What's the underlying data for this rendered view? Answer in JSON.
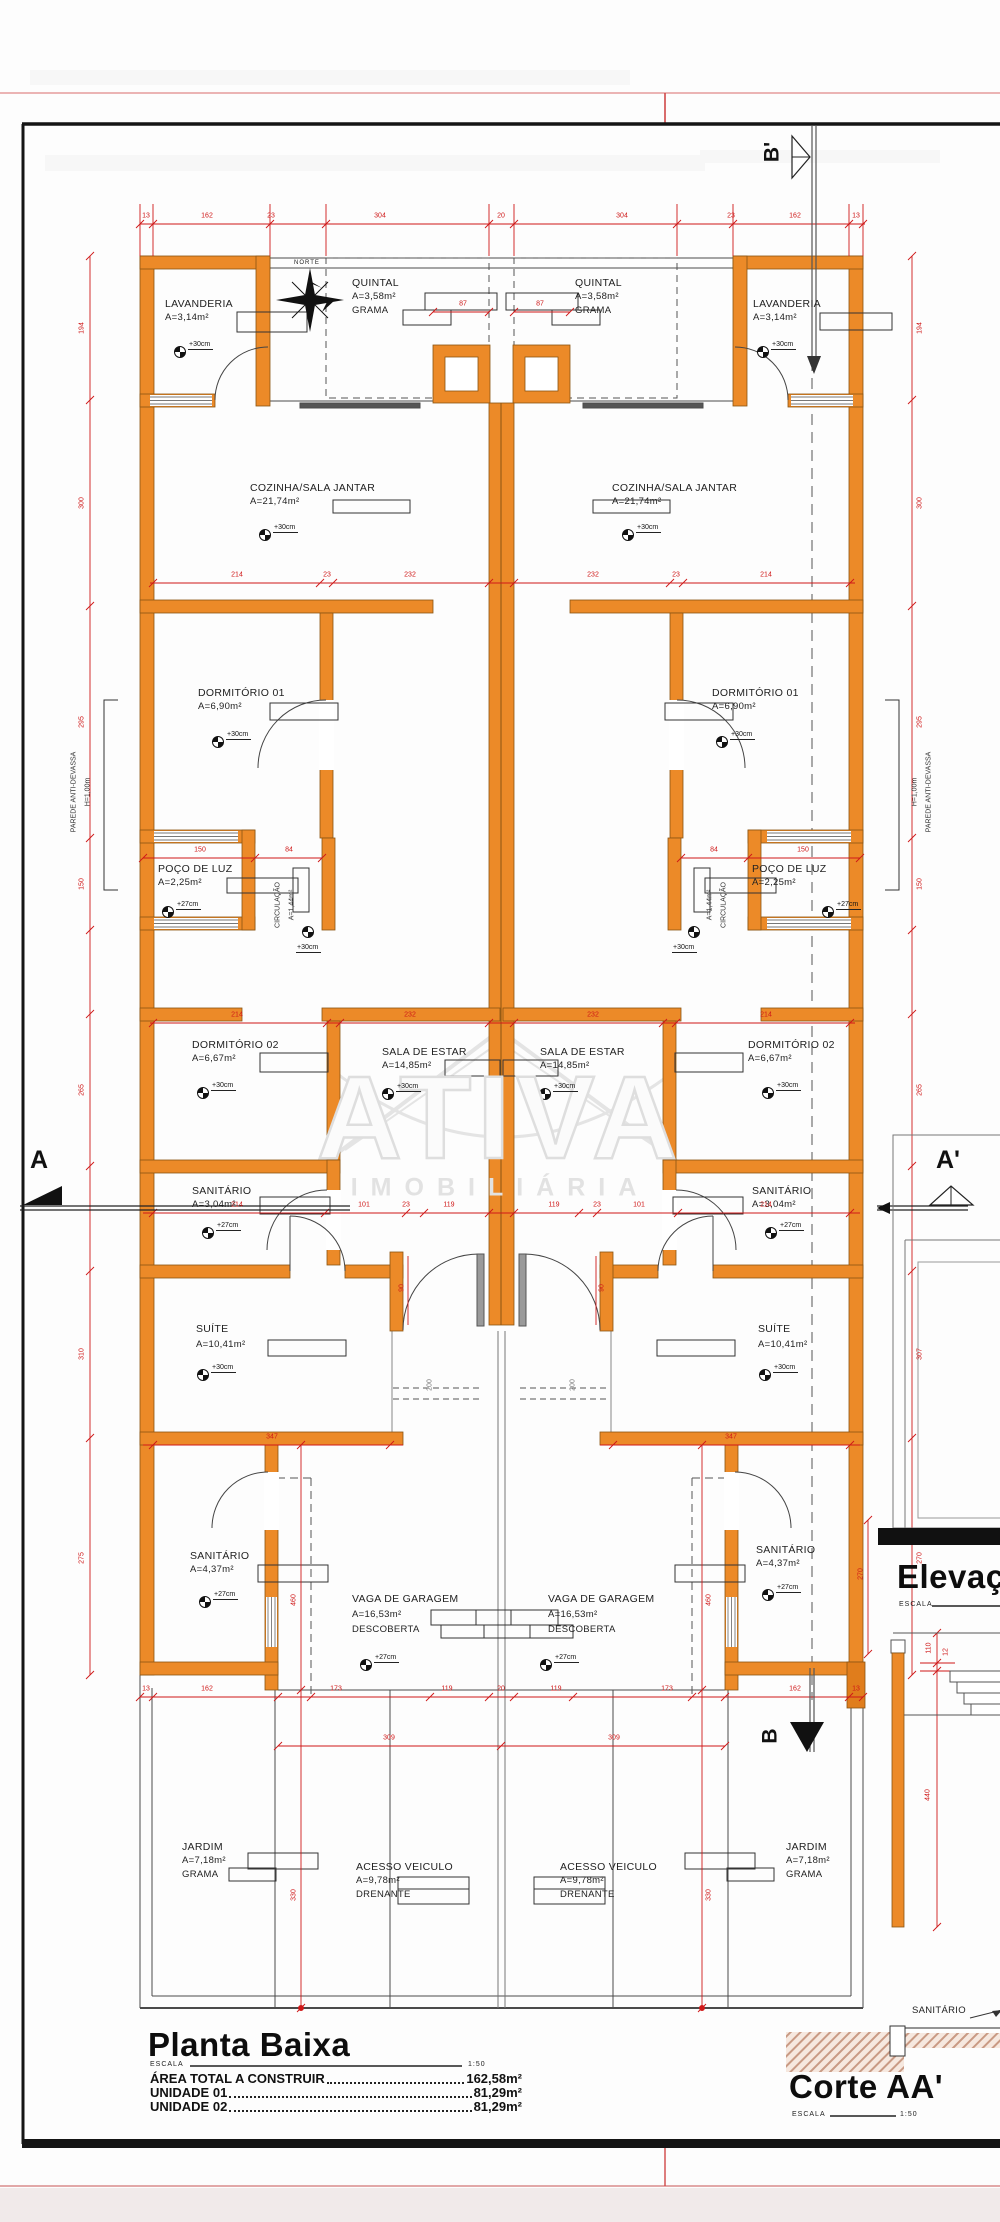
{
  "sheet": {
    "wall_color": "#EC8A28",
    "dim_color": "#CF1818"
  },
  "watermark": {
    "line1": "ATIVA",
    "line2": "IMOBILIÁRIA"
  },
  "compass_label": "NORTE",
  "markers": {
    "a": "A",
    "a_prime": "A'",
    "b": "B",
    "b_prime": "B'"
  },
  "notes": {
    "parede": "PAREDE ANTI-DEVASSA",
    "parede_h": "H=1,00m",
    "corte_sanitario": "SANITÁRIO"
  },
  "rooms": {
    "lavanderia": {
      "name": "LAVANDERIA",
      "area": "A=3,14m²",
      "level": "+30cm"
    },
    "quintal": {
      "name": "QUINTAL",
      "area": "A=3,58m²",
      "extra": "GRAMA"
    },
    "cozinha": {
      "name": "COZINHA/SALA JANTAR",
      "area": "A=21,74m²",
      "level": "+30cm"
    },
    "dormitorio1": {
      "name": "DORMITÓRIO 01",
      "area": "A=6,90m²",
      "level": "+30cm"
    },
    "poco": {
      "name": "POÇO DE LUZ",
      "area": "A=2,25m²",
      "level": "+27cm"
    },
    "circulacao": {
      "name": "CIRCULAÇÃO",
      "area": "A=1,44m²",
      "level": "+30cm"
    },
    "dormitorio2": {
      "name": "DORMITÓRIO 02",
      "area": "A=6,67m²",
      "level": "+30cm"
    },
    "sala": {
      "name": "SALA DE ESTAR",
      "area": "A=14,85m²",
      "level": "+30cm"
    },
    "sanitario1": {
      "name": "SANITÁRIO",
      "area": "A=3,04m²",
      "level": "+27cm"
    },
    "suite": {
      "name": "SUÍTE",
      "area": "A=10,41m²",
      "level": "+30cm"
    },
    "sanitario2": {
      "name": "SANITÁRIO",
      "area": "A=4,37m²",
      "level": "+27cm"
    },
    "vaga": {
      "name": "VAGA DE GARAGEM",
      "area": "A=16,53m²",
      "extra": "DESCOBERTA",
      "level": "+27cm"
    },
    "jardim": {
      "name": "JARDIM",
      "area": "A=7,18m²",
      "extra": "GRAMA"
    },
    "acesso": {
      "name": "ACESSO VEICULO",
      "area": "A=9,78m²",
      "extra": "DRENANTE"
    }
  },
  "dims": {
    "top": [
      "13",
      "162",
      "23",
      "304",
      "20",
      "304",
      "23",
      "162",
      "13"
    ],
    "row2": [
      "214",
      "23",
      "232",
      "232",
      "23",
      "214"
    ],
    "row3": [
      "150",
      "84",
      "84",
      "150"
    ],
    "row4": [
      "214",
      "232",
      "232",
      "214"
    ],
    "row5": [
      "214",
      "101",
      "23",
      "119",
      "119",
      "23",
      "101",
      "214"
    ],
    "row6": [
      "347",
      "347"
    ],
    "row7": [
      "13",
      "162",
      "173",
      "119",
      "20",
      "119",
      "173",
      "162",
      "13"
    ],
    "row8": [
      "309",
      "309"
    ],
    "left_v": [
      "194",
      "300",
      "295",
      "150",
      "265",
      "310",
      "275"
    ],
    "right_v": [
      "194",
      "300",
      "295",
      "150",
      "265",
      "307",
      "270"
    ],
    "quintal": [
      "87",
      "87"
    ],
    "door": [
      "90",
      "90"
    ],
    "porch": [
      "200",
      "200"
    ],
    "garden_v": [
      "460",
      "330",
      "460",
      "330"
    ],
    "corte": [
      "270",
      "110",
      "12",
      "440"
    ]
  },
  "titles": {
    "plan": "Planta Baixa",
    "scale_label": "ESCALA",
    "plan_scale": "1:50",
    "area_total_label": "ÁREA TOTAL A CONSTRUIR",
    "area_total_value": "162,58m²",
    "unit1_label": "UNIDADE 01",
    "unit1_value": "81,29m²",
    "unit2_label": "UNIDADE 02",
    "unit2_value": "81,29m²",
    "elevation": "Elevação",
    "elevation_scale_label": "ESCALA",
    "section": "Corte AA'",
    "section_scale_label": "ESCALA",
    "section_scale": "1:50"
  }
}
